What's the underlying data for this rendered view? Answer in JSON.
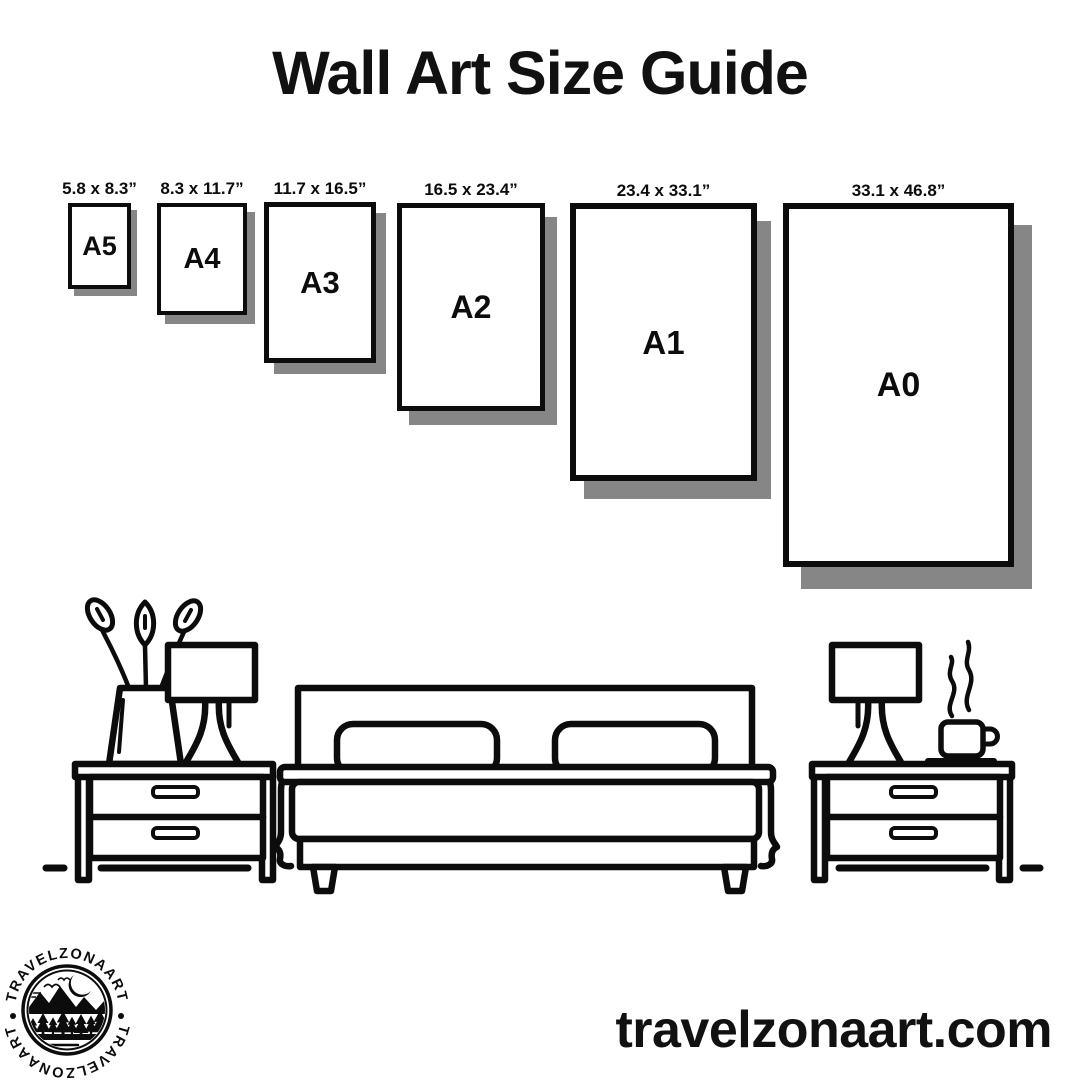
{
  "title": "Wall Art Size Guide",
  "papers": [
    {
      "name": "A5",
      "dims": "5.8 x 8.3”"
    },
    {
      "name": "A4",
      "dims": "8.3 x 11.7”"
    },
    {
      "name": "A3",
      "dims": "11.7 x 16.5”"
    },
    {
      "name": "A2",
      "dims": "16.5 x 23.4”"
    },
    {
      "name": "A1",
      "dims": "23.4 x 33.1”"
    },
    {
      "name": "A0",
      "dims": "33.1 x 46.8”"
    }
  ],
  "logo": {
    "text_top": "TRAVELZONAART",
    "text_bottom": "TRAVELZONAART"
  },
  "footer": {
    "website": "travelzonaart.com"
  },
  "illustration": {
    "items": [
      "vase-with-flowers",
      "table-lamp-left",
      "nightstand-left",
      "double-bed-with-pillows",
      "table-lamp-right",
      "coffee-cup-with-steam",
      "nightstand-right",
      "floor-line"
    ]
  },
  "colors": {
    "ink": "#0c0c0c",
    "shadow": "#868686",
    "background": "#ffffff"
  }
}
